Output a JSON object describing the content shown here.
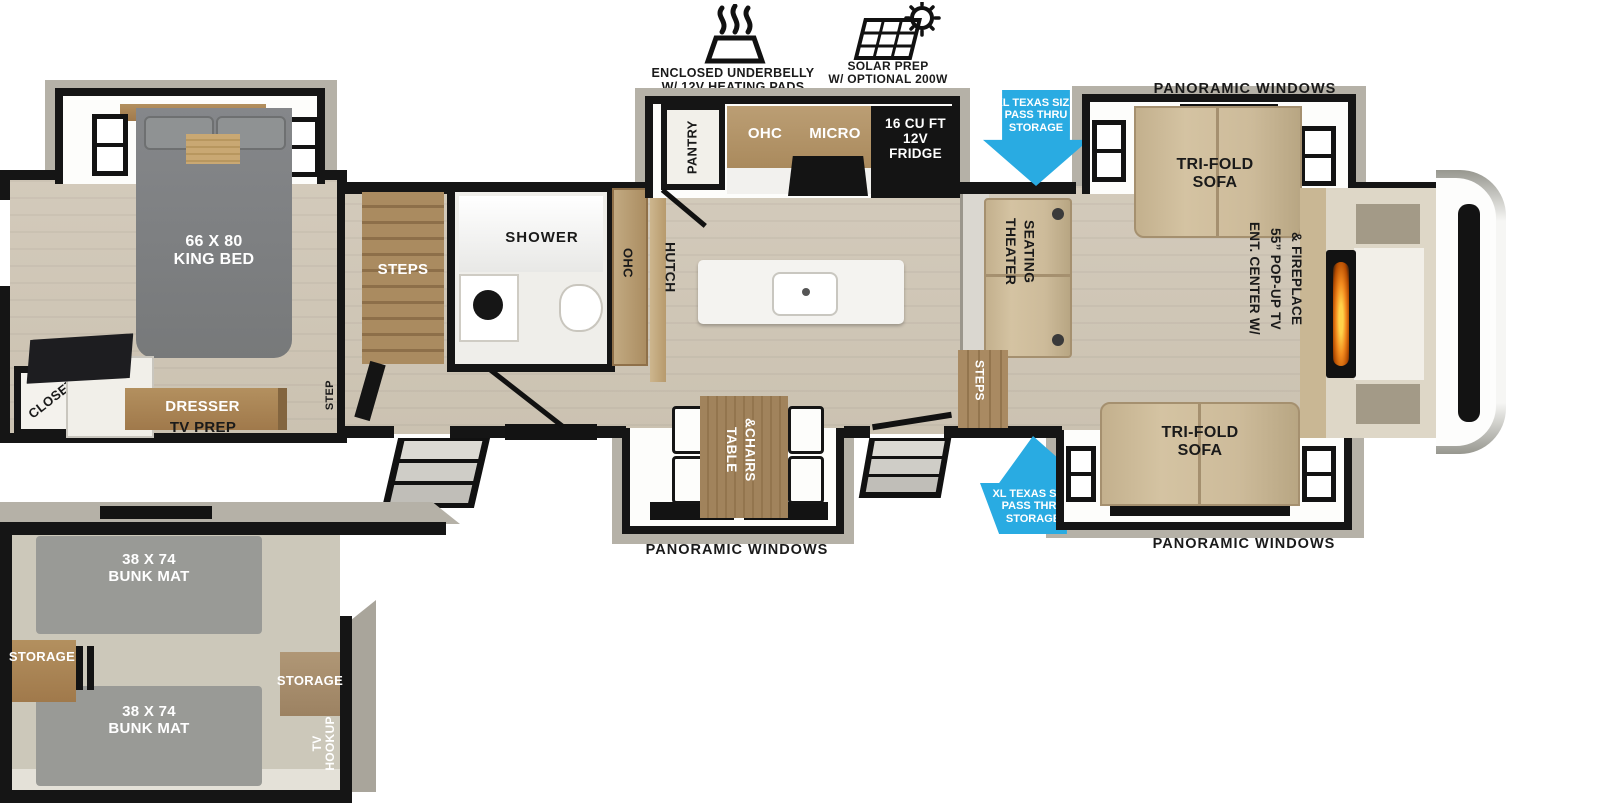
{
  "icons": {
    "underbelly_label": "ENCLOSED UNDERBELLY\nW/ 12V HEATING PADS",
    "solar_label": "SOLAR PREP\nW/ OPTIONAL 200W\nSOLAR PACKAGE"
  },
  "callouts": {
    "pass_thru_top": "XL TEXAS SIZE\nPASS THRU\nSTORAGE",
    "pass_thru_bottom": "XL TEXAS SIZE\nPASS THRU\nSTORAGE"
  },
  "exterior": {
    "panoramic_top": "PANORAMIC WINDOWS",
    "panoramic_bottom_left": "PANORAMIC WINDOWS",
    "panoramic_bottom_right": "PANORAMIC WINDOWS"
  },
  "bedroom": {
    "king_bed": "66 X 80\nKING BED",
    "closet": "CLOSET",
    "dresser": "DRESSER",
    "tv_prep": "TV PREP",
    "step": "STEP"
  },
  "bath": {
    "shower": "SHOWER",
    "stairs": "STEPS",
    "ohc": "OHC"
  },
  "kitchen": {
    "pantry": "PANTRY",
    "ohc": "OHC",
    "micro": "MICRO",
    "fridge": "16 CU FT\n12V\nFRIDGE",
    "hutch": "HUTCH"
  },
  "dinette": {
    "table_chairs": "TABLE\n&CHAIRS"
  },
  "living": {
    "theater_seating": "THEATER\nSEATING",
    "steps": "STEPS",
    "sofa_top": "TRI-FOLD\nSOFA",
    "sofa_bottom": "TRI-FOLD\nSOFA",
    "ent_center": "ENT. CENTER W/\n55” POP-UP TV\n& FIREPLACE"
  },
  "bunk_room": {
    "bunk_top": "38 X 74\nBUNK MAT",
    "bunk_bottom": "38 X 74\nBUNK MAT",
    "storage_left": "STORAGE",
    "storage_right": "STORAGE",
    "tv_hookup": "TV\nHOOKUP"
  },
  "colors": {
    "arrow_blue": "#29ABE2",
    "wall_black": "#151515",
    "floor_tan": "#CFC6B6",
    "cabinet_wood": "#A8875D",
    "sofa_tan": "#CDBB9A",
    "bed_gray": "#7C7E7D",
    "slide_gray": "#B5B1A7",
    "flame_orange": "#F28A1E"
  }
}
